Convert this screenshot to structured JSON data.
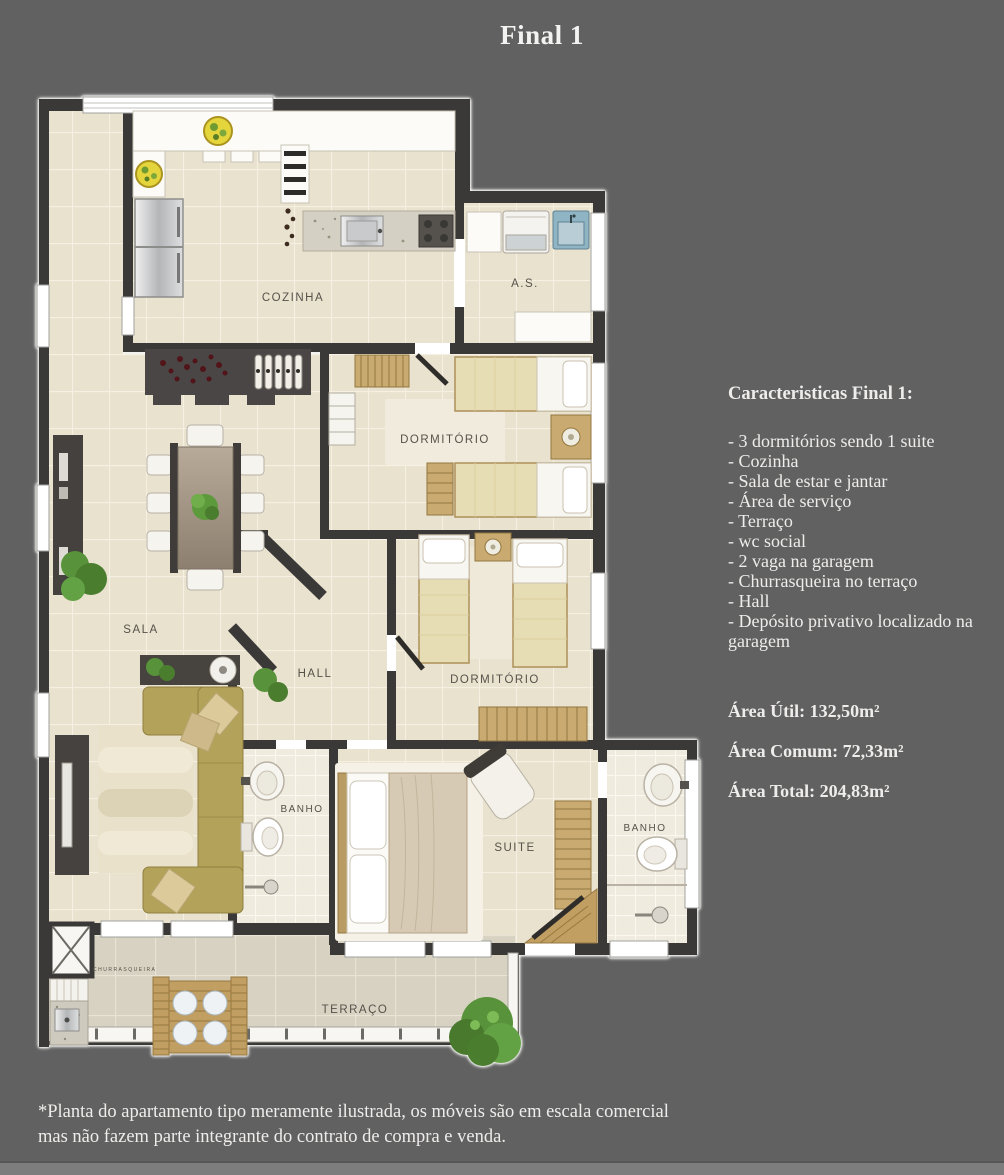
{
  "title": "Final 1",
  "plan": {
    "labels": {
      "cozinha": "COZINHA",
      "as": "A.S.",
      "dormitorio1": "DORMITÓRIO",
      "sala": "SALA",
      "hall": "HALL",
      "dormitorio2": "DORMITÓRIO",
      "banho1": "BANHO",
      "suite": "SUITE",
      "banho2": "BANHO",
      "terraco": "TERRAÇO",
      "churrasqueira": "CHURRASQUEIRA"
    }
  },
  "details": {
    "heading": "Caracteristicas Final 1:",
    "features": [
      "- 3 dormitórios sendo 1 suite",
      "- Cozinha",
      "- Sala de estar e jantar",
      "- Área de serviço",
      "- Terraço",
      "- wc social",
      "- 2 vaga na garagem",
      "- Churrasqueira no terraço",
      "- Hall",
      "- Depósito privativo localizado na garagem"
    ],
    "areas": [
      "Área Útil: 132,50m²",
      "Área Comum: 72,33m²",
      "Área Total: 204,83m²"
    ]
  },
  "disclaimer": "*Planta do apartamento tipo meramente ilustrada, os móveis são em escala comercial mas não fazem parte integrante do contrato de compra e venda.",
  "colors": {
    "background": "#616161",
    "wall": "#3a3938",
    "floor": "#e9e2cf",
    "terrace_floor": "#d8d2c3",
    "sofa": "#b3a259",
    "wood": "#c19e62",
    "plant": "#58923a",
    "text": "#eeedeb"
  }
}
